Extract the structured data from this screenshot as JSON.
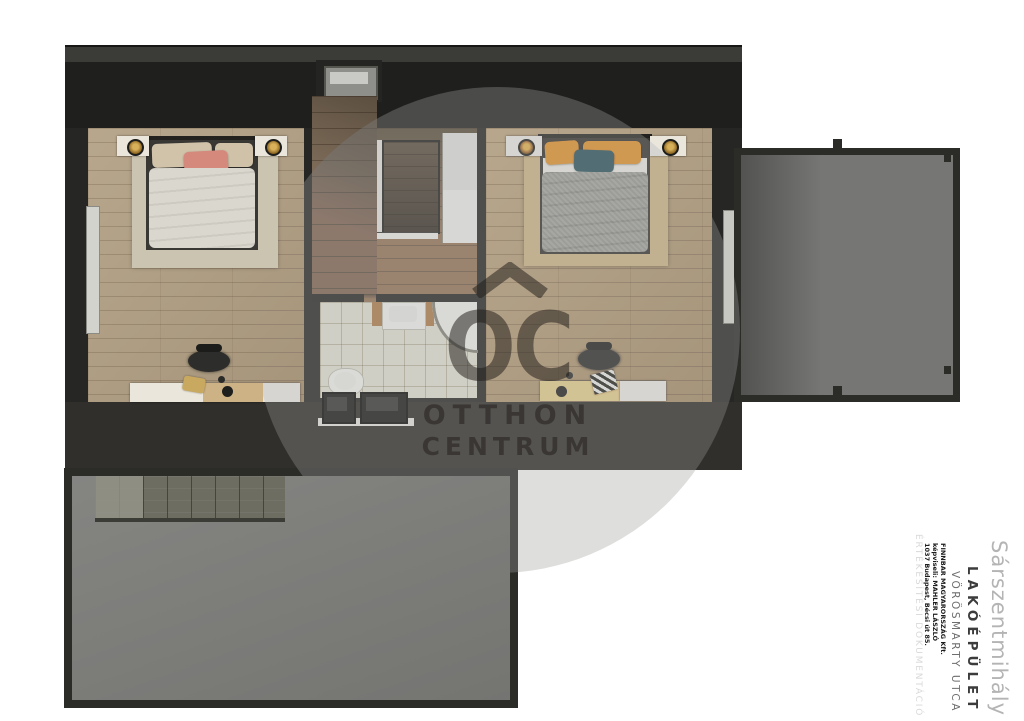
{
  "watermark": {
    "logo_letters": "OC",
    "brand_line1": "OTTHON",
    "brand_line2": "CENTRUM"
  },
  "title_block": {
    "city": "Sárszentmihály",
    "building_type": "LAKÓÉPÜLET",
    "street": "VÖRÖSMARTY UTCA",
    "developer": "FINNBAR MAGYARORSZÁG Kft.",
    "representative": "képviseli: MAHLER LÁSZLÓ",
    "developer_address": "1037 Budapest, Bécsi út 85.",
    "document_type": "ÉRTÉKESÍTÉSI DOKUMENTÁCIÓ"
  },
  "colors": {
    "wall_dark": "#262624",
    "wood_floor": "#b2a084",
    "bathroom_tile": "#d7d3c5",
    "terrace_gray": "#7d7d7a",
    "balcony_gray": "#767674",
    "accent_coral": "#d4897c",
    "accent_mustard": "#d6992c",
    "accent_teal": "#2d6572",
    "watermark_gray": "#dedede"
  }
}
